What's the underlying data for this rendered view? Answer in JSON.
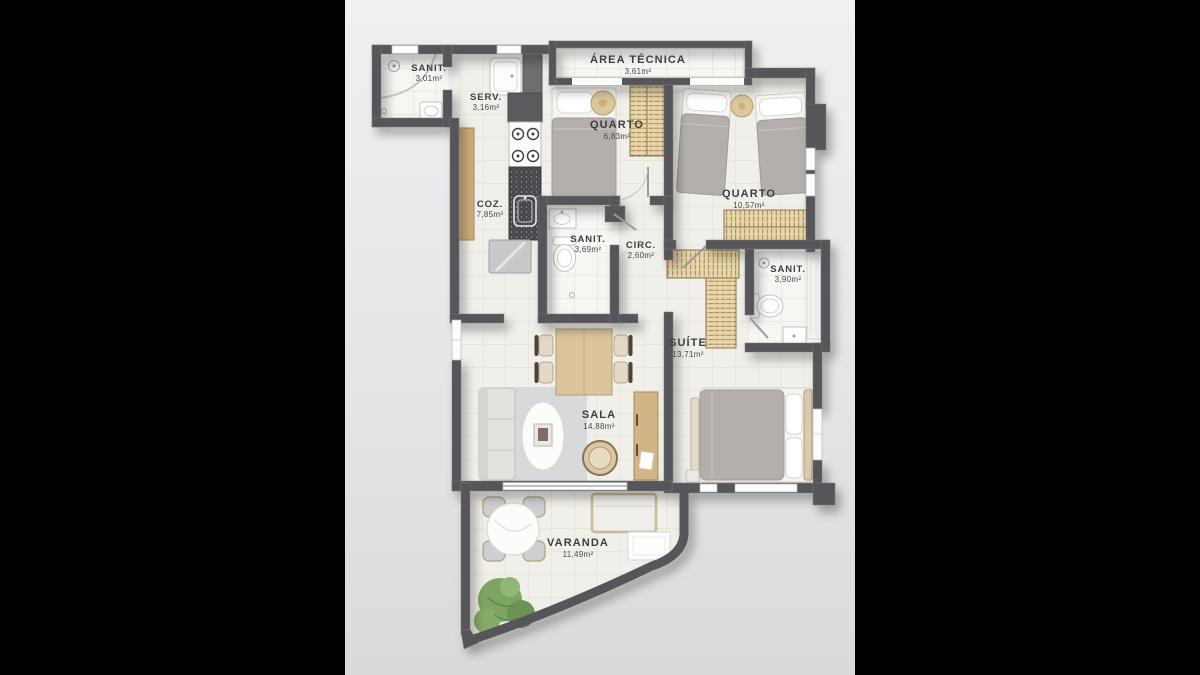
{
  "scene": {
    "type": "apartment-floor-plan",
    "letterbox_color": "#000000",
    "background_top": "#f0f0f1",
    "background_bottom": "#d9dadc",
    "wall_color": "#57575a",
    "floor_color": "#f1efe9",
    "tile_line_color": "#e1dcd3",
    "wood_color": "#cfae7e",
    "wardrobe_color": "#e8d5a8",
    "counter_color": "#47474c",
    "blanket_color": "#b4afac",
    "plant_color": "#7ea464",
    "label_color": "#3e3e41"
  },
  "rooms": [
    {
      "id": "sanit-1",
      "name": "SANIT.",
      "area": "3,01m²"
    },
    {
      "id": "serv",
      "name": "SERV.",
      "area": "3,16m²"
    },
    {
      "id": "area-tecnica",
      "name": "ÁREA TÉCNICA",
      "area": "3,61m²"
    },
    {
      "id": "quarto-1",
      "name": "QUARTO",
      "area": "6,83m²"
    },
    {
      "id": "quarto-2",
      "name": "QUARTO",
      "area": "10,57m²"
    },
    {
      "id": "coz",
      "name": "COZ.",
      "area": "7,85m²"
    },
    {
      "id": "sanit-2",
      "name": "SANIT.",
      "area": "3,69m²"
    },
    {
      "id": "circ",
      "name": "CIRC.",
      "area": "2,60m²"
    },
    {
      "id": "sanit-3",
      "name": "SANIT.",
      "area": "3,90m²"
    },
    {
      "id": "suite",
      "name": "SUÍTE",
      "area": "13,71m²"
    },
    {
      "id": "sala",
      "name": "SALA",
      "area": "14,88m²"
    },
    {
      "id": "varanda",
      "name": "VARANDA",
      "area": "11,49m²"
    }
  ]
}
